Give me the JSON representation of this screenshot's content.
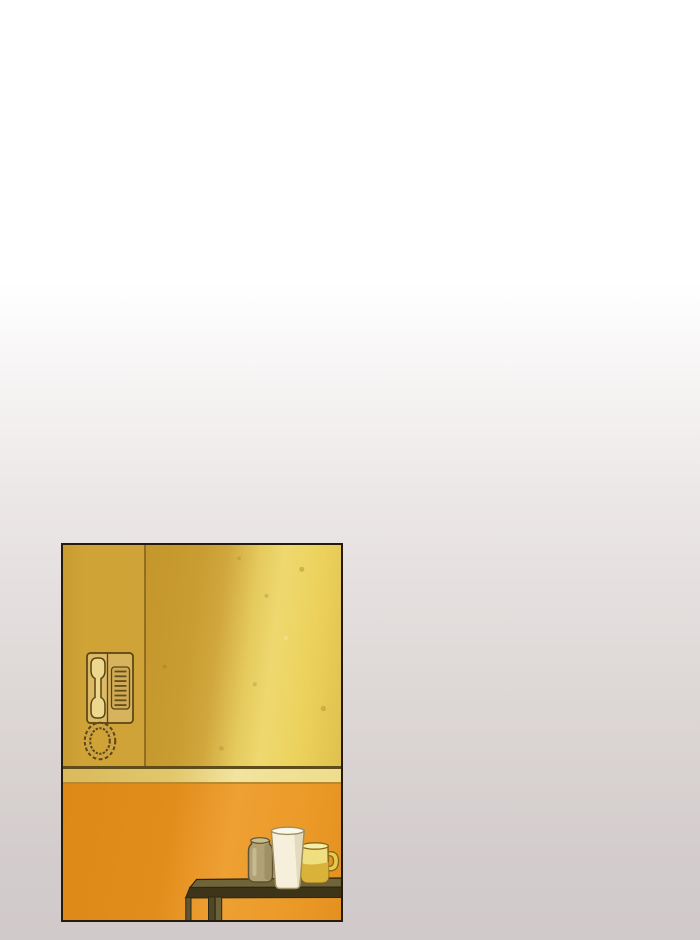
{
  "page": {
    "type": "webtoon-comic-page",
    "visible_text": "none",
    "background_top_color": "#ffffff",
    "background_bottom_color": "#d1caca"
  },
  "panel": {
    "description": "single borderless-margin comic panel, interior hallway scene",
    "position": {
      "x": 61,
      "y": 543,
      "width": 283,
      "height": 380
    },
    "border_color": "#241b0c",
    "scene": {
      "upper_wall": {
        "name": "yellow-wall",
        "base_color": "#cfa336",
        "lit_color": "#eed86f",
        "seam_line_color": "#86661e",
        "texture": "small speckle dots"
      },
      "molding": {
        "name": "baseboard-molding",
        "color": "#eedd8c",
        "shadow_line_color": "#5f4c1b"
      },
      "lower_wall": {
        "name": "orange-wall",
        "base_color": "#e18d1c",
        "lit_color": "#efa033"
      },
      "intercom": {
        "name": "wall-intercom-phone",
        "body_color": "#d7b35e",
        "handset_color": "#ecd78d",
        "grille_line_count": 8,
        "cord": "coiled loop hanging below unit"
      },
      "table": {
        "name": "side-table",
        "top_color": "#6f6539",
        "edge_color": "#3d341a",
        "legs_visible": 3
      },
      "vessels": [
        {
          "name": "jar",
          "color": "#b1a175"
        },
        {
          "name": "tall-cup",
          "color": "#f5efdc"
        },
        {
          "name": "mug",
          "color": "#f0df7f",
          "accent_color": "#d9b339",
          "handle_side": "right"
        }
      ]
    }
  }
}
